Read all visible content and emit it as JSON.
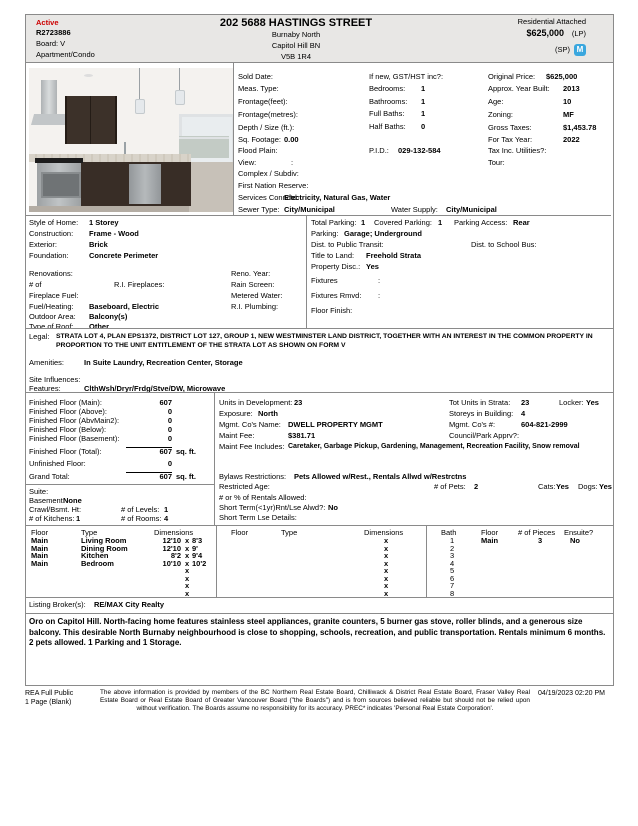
{
  "header": {
    "status": "Active",
    "mls_number": "R2723886",
    "board": "Board: V",
    "dwelling_type": "Apartment/Condo",
    "address": "202 5688 HASTINGS STREET",
    "area": "Burnaby North",
    "subarea": "Capitol Hill BN",
    "postal_code": "V5B 1R4",
    "property_class": "Residential Attached",
    "list_price": "$625,000",
    "lp_label": "(LP)",
    "sp_label": "(SP)",
    "logo_letter": "M",
    "accent_red": "#cc0000",
    "logo_blue": "#3aa7de"
  },
  "listing": {
    "col1": [
      {
        "label": "Sold Date:",
        "value": ""
      },
      {
        "label": "Meas. Type:",
        "value": ""
      },
      {
        "label": "Frontage(feet):",
        "value": ""
      },
      {
        "label": "Frontage(metres):",
        "value": ""
      },
      {
        "label": "Depth / Size (ft.):",
        "value": ""
      },
      {
        "label": "Sq. Footage:",
        "value": "0.00"
      }
    ],
    "col2": [
      {
        "label": "If new, GST/HST inc?:",
        "value": ""
      },
      {
        "label": "Bedrooms:",
        "value": "1"
      },
      {
        "label": "Bathrooms:",
        "value": "1"
      },
      {
        "label": "Full Baths:",
        "value": "1"
      },
      {
        "label": "Half Baths:",
        "value": "0"
      }
    ],
    "col3": [
      {
        "label": "Original Price:",
        "value": "$625,000"
      },
      {
        "label": "Approx. Year Built:",
        "value": "2013"
      },
      {
        "label": "Age:",
        "value": "10"
      },
      {
        "label": "Zoning:",
        "value": "MF"
      },
      {
        "label": "Gross Taxes:",
        "value": "$1,453.78"
      },
      {
        "label": "For Tax Year:",
        "value": "2022"
      }
    ],
    "flood_plain": {
      "label": "Flood Plain:",
      "value": ""
    },
    "pid": {
      "label": "P.I.D.:",
      "value": "029-132-584"
    },
    "tax_inc": {
      "label": "Tax Inc. Utilities?:",
      "value": ""
    },
    "view": {
      "label": "View:",
      "value": ":"
    },
    "tour": {
      "label": "Tour:",
      "value": ""
    },
    "complex": {
      "label": "Complex / Subdiv:",
      "value": ""
    },
    "first_nation": {
      "label": "First Nation Reserve:",
      "value": ""
    },
    "services": {
      "label": "Services Connctd:",
      "value": "Electricity, Natural Gas, Water"
    },
    "sewer": {
      "label": "Sewer Type:",
      "value": "City/Municipal"
    },
    "water": {
      "label": "Water Supply:",
      "value": "City/Municipal"
    }
  },
  "construction": {
    "style": {
      "label": "Style of Home:",
      "value": "1 Storey"
    },
    "construction": {
      "label": "Construction:",
      "value": "Frame - Wood"
    },
    "exterior": {
      "label": "Exterior:",
      "value": "Brick"
    },
    "foundation": {
      "label": "Foundation:",
      "value": "Concrete Perimeter"
    },
    "renovations": {
      "label": "Renovations:",
      "value": ""
    },
    "reno_year": {
      "label": "Reno. Year:",
      "value": ""
    },
    "num_of": {
      "label": "# of",
      "value": ""
    },
    "ri_fireplaces": {
      "label": "R.I. Fireplaces:",
      "value": ""
    },
    "rain_screen": {
      "label": "Rain Screen:",
      "value": ""
    },
    "fireplace_fuel": {
      "label": "Fireplace Fuel:",
      "value": ""
    },
    "metered_water": {
      "label": "Metered Water:",
      "value": ""
    },
    "fuel_heating": {
      "label": "Fuel/Heating:",
      "value": "Baseboard, Electric"
    },
    "ri_plumbing": {
      "label": "R.I. Plumbing:",
      "value": ""
    },
    "outdoor_area": {
      "label": "Outdoor Area:",
      "value": "Balcony(s)"
    },
    "type_of_roof": {
      "label": "Type of Roof:",
      "value": "Other"
    }
  },
  "parking": {
    "total": {
      "label": "Total Parking:",
      "value": "1"
    },
    "covered": {
      "label": "Covered Parking:",
      "value": "1"
    },
    "access": {
      "label": "Parking Access:",
      "value": "Rear"
    },
    "parking": {
      "label": "Parking:",
      "value": "Garage; Underground"
    },
    "transit": {
      "label": "Dist. to Public Transit:",
      "value": ""
    },
    "school_bus": {
      "label": "Dist. to School Bus:",
      "value": ""
    },
    "title": {
      "label": "Title to Land:",
      "value": "Freehold Strata"
    },
    "disc": {
      "label": "Property Disc.:",
      "value": "Yes"
    },
    "fixtures": {
      "label": "Fixtures",
      "value": ":"
    },
    "fixtures_rmvd": {
      "label": "Fixtures Rmvd:",
      "value": ":"
    },
    "floor_finish": {
      "label": "Floor Finish:",
      "value": ""
    }
  },
  "legal": {
    "label": "Legal:",
    "text": "STRATA LOT 4, PLAN EPS1372, DISTRICT LOT 127, GROUP 1, NEW WESTMINSTER LAND DISTRICT, TOGETHER WITH AN INTEREST IN THE COMMON PROPERTY IN PROPORTION TO THE UNIT ENTITLEMENT OF THE STRATA LOT AS SHOWN ON FORM V",
    "amenities": {
      "label": "Amenities:",
      "value": "In Suite Laundry, Recreation Center, Storage"
    },
    "site_influences": {
      "label": "Site Influences:",
      "value": ""
    },
    "features": {
      "label": "Features:",
      "value": "ClthWsh/Dryr/Frdg/Stve/DW, Microwave"
    }
  },
  "floor_area": {
    "rows": [
      {
        "label": "Finished Floor (Main):",
        "value": "607",
        "unit": ""
      },
      {
        "label": "Finished Floor (Above):",
        "value": "0",
        "unit": ""
      },
      {
        "label": "Finished Floor (AbvMain2):",
        "value": "0",
        "unit": ""
      },
      {
        "label": "Finished Floor (Below):",
        "value": "0",
        "unit": ""
      },
      {
        "label": "Finished Floor (Basement):",
        "value": "0",
        "unit": ""
      },
      {
        "label": "Finished Floor (Total):",
        "value": "607",
        "unit": "sq. ft."
      },
      {
        "label": "Unfinished Floor:",
        "value": "0",
        "unit": ""
      },
      {
        "label": "Grand Total:",
        "value": "607",
        "unit": "sq. ft."
      }
    ],
    "suite": {
      "label": "Suite:",
      "value": ""
    },
    "basement": {
      "label": "Basement:",
      "value": "None"
    },
    "crawl": {
      "label": "Crawl/Bsmt. Ht:",
      "value": ""
    },
    "levels": {
      "label": "# of Levels:",
      "value": "1"
    },
    "kitchens": {
      "label": "# of Kitchens:",
      "value": "1"
    },
    "rooms": {
      "label": "# of Rooms:",
      "value": "4"
    }
  },
  "strata": {
    "units_dev": {
      "label": "Units in Development:",
      "value": "23"
    },
    "tot_units": {
      "label": "Tot Units in Strata:",
      "value": "23"
    },
    "locker": {
      "label": "Locker:",
      "value": "Yes"
    },
    "exposure": {
      "label": "Exposure:",
      "value": "North"
    },
    "storeys": {
      "label": "Storeys in Building:",
      "value": "4"
    },
    "mgmt_name": {
      "label": "Mgmt. Co's Name:",
      "value": "DWELL PROPERTY MGMT"
    },
    "mgmt_num": {
      "label": "Mgmt. Co's #:",
      "value": "604-821-2999"
    },
    "maint_fee": {
      "label": "Maint Fee:",
      "value": "$381.71"
    },
    "council": {
      "label": "Council/Park Apprv?:",
      "value": ""
    },
    "maint_inc": {
      "label": "Maint Fee Includes:",
      "value": "Caretaker, Garbage Pickup, Gardening, Management, Recreation Facility, Snow removal"
    },
    "bylaws": {
      "label": "Bylaws Restrictions:",
      "value": "Pets Allowed w/Rest., Rentals Allwd w/Restrctns"
    },
    "restricted_age": {
      "label": "Restricted Age:",
      "value": ""
    },
    "pets": {
      "label": "# of Pets:",
      "value": "2"
    },
    "cats": {
      "label": "Cats:",
      "value": "Yes"
    },
    "dogs": {
      "label": "Dogs:",
      "value": "Yes"
    },
    "rentals_allowed": {
      "label": "# or % of Rentals Allowed:",
      "value": ""
    },
    "short_term": {
      "label": "Short Term(<1yr)Rnt/Lse Alwd?:",
      "value": "No"
    },
    "short_term_details": {
      "label": "Short Term Lse Details:",
      "value": ""
    }
  },
  "rooms": {
    "headers": [
      "Floor",
      "Type",
      "Dimensions"
    ],
    "x_marker": "x",
    "rows": [
      {
        "floor": "Main",
        "type": "Living Room",
        "d1": "12'10",
        "d2": "8'3"
      },
      {
        "floor": "Main",
        "type": "Dining Room",
        "d1": "12'10",
        "d2": "9'"
      },
      {
        "floor": "Main",
        "type": "Kitchen",
        "d1": "8'2",
        "d2": "9'4"
      },
      {
        "floor": "Main",
        "type": "Bedroom",
        "d1": "10'10",
        "d2": "10'2"
      }
    ]
  },
  "baths": {
    "headers": [
      "Bath",
      "Floor",
      "# of Pieces",
      "Ensuite?"
    ],
    "rows": [
      {
        "num": "1",
        "floor": "Main",
        "pieces": "3",
        "ensuite": "No"
      },
      {
        "num": "2",
        "floor": "",
        "pieces": "",
        "ensuite": ""
      },
      {
        "num": "3",
        "floor": "",
        "pieces": "",
        "ensuite": ""
      },
      {
        "num": "4",
        "floor": "",
        "pieces": "",
        "ensuite": ""
      },
      {
        "num": "5",
        "floor": "",
        "pieces": "",
        "ensuite": ""
      },
      {
        "num": "6",
        "floor": "",
        "pieces": "",
        "ensuite": ""
      },
      {
        "num": "7",
        "floor": "",
        "pieces": "",
        "ensuite": ""
      },
      {
        "num": "8",
        "floor": "",
        "pieces": "",
        "ensuite": ""
      }
    ]
  },
  "broker": {
    "label": "Listing Broker(s):",
    "value": "RE/MAX City Realty"
  },
  "remarks": "Oro on Capitol Hill. North-facing home features stainless steel appliances, granite counters, 5 burner gas stove, roller blinds, and a generous size balcony. This desirable North Burnaby neighbourhood is close to shopping, schools, recreation, and public transportation. Rentals minimum 6 months. 2 pets allowed. 1 Parking and 1 Storage.",
  "footer": {
    "report_name_line1": "REA Full Public",
    "report_name_line2": "1 Page (Blank)",
    "disclaimer": "The above information is provided by members of the BC Northern Real Estate Board, Chilliwack & District Real Estate Board, Fraser Valley Real Estate Board or Real Estate Board of Greater Vancouver Board (\"the Boards\") and is from sources believed reliable but should not be relied upon without verification. The Boards assume no responsibility for its accuracy. PREC* indicates 'Personal Real Estate Corporation'.",
    "datetime": "04/19/2023 02:20 PM"
  }
}
